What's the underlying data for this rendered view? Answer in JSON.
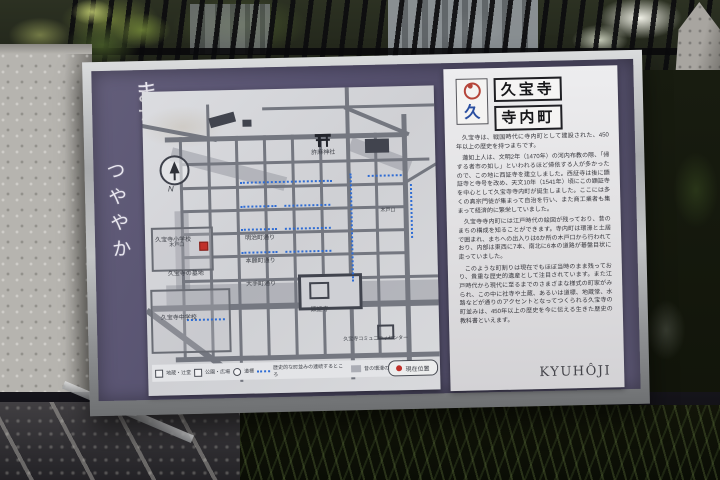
{
  "sign": {
    "calligraphy": {
      "line1": "まち",
      "line2": "つややか"
    },
    "title_panel": {
      "logo_symbol_char": "久",
      "line1": "久宝寺",
      "line2": "寺内町"
    },
    "body": {
      "p1": "久宝寺は、戦国時代に寺内町として建設された、450年以上の歴史を持つまちです。",
      "p2": "蓮如上人は、文明2年（1470年）の河内布教の際、「帰する者市の如し」といわれるほど帰依する人が多かったので、この地に西証寺を建立しました。西証寺は後に顕証寺と寺号を改め、天文10年（1541年）頃にこの顕証寺を中心として久宝寺寺内町が誕生しました。ここには多くの真宗門徒が集まって自治を行い、また商工業者も集まって経済的に繁栄していました。",
      "p3": "久宝寺寺内町には江戸時代の絵図が残っており、昔のまちの構成を知ることができます。寺内町は環濠と土居で囲まれ、まちへの出入りは6か所の木戸口から行われており、内部は東西に7本、南北に6本の道路が碁盤目状に走っていました。",
      "p4": "このような町割りは現在でもほぼ当時のまま残っており、貴重な歴史的遺産として注目されています。また江戸時代から現代に至るまでのさまざまな様式の町家がみられ、この中に社寺や土蔵、あるいは道標、地蔵堂、水路などが通りのアクセントとなってつくられる久宝寺の町並みは、450年以上の歴史を今に伝える生きた歴史の教科書といえます。"
    },
    "footer_romaji": "KYUHÔJI"
  },
  "map": {
    "compass_label": "N",
    "labels": {
      "shrine": "許麻神社",
      "temple": "顕証寺",
      "elementary_school": "久宝寺小学校",
      "junior_high_school": "久宝寺中学校",
      "cemetery": "久宝寺の墓地",
      "community_center": "久宝寺コミュニティセンター",
      "gate1": "木戸口",
      "gate2": "木戸口",
      "street1": "明治町通り",
      "street2": "本願町通り",
      "street3": "大手町通り"
    },
    "legend": {
      "item1": "地蔵・辻堂",
      "item2": "公園・広場",
      "item3": "道標",
      "item4": "歴史的な町並みの連続するところ",
      "item5": "昔の環濠の位置",
      "current_location": "現在位置"
    }
  },
  "colors": {
    "mat_purple": "#575270",
    "logo_red": "#b5453a",
    "logo_blue": "#2b4fa0",
    "route_blue": "#2e6cd4",
    "marker_red": "#c0302a",
    "frame_silver": "#c2c4c5"
  }
}
